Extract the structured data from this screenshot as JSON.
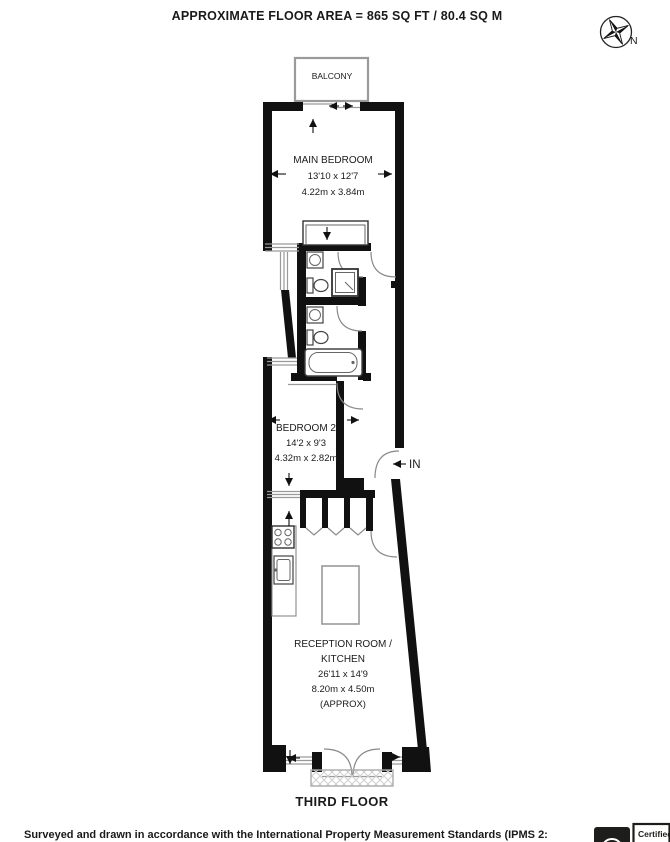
{
  "title": "APPROXIMATE FLOOR AREA = 865 SQ FT / 80.4 SQ M",
  "compass": {
    "north_label": "N"
  },
  "balcony_label": "BALCONY",
  "rooms": {
    "main_bedroom": {
      "name": "MAIN BEDROOM",
      "imperial": "13'10 x 12'7",
      "metric": "4.22m x 3.84m"
    },
    "bedroom2": {
      "name": "BEDROOM 2",
      "imperial": "14'2 x 9'3",
      "metric": "4.32m x 2.82m"
    },
    "reception": {
      "name_line1": "RECEPTION ROOM /",
      "name_line2": "KITCHEN",
      "imperial": "26'11 x 14'9",
      "metric": "8.20m x 4.50m",
      "approx": "(APPROX)"
    }
  },
  "entrance_label": "IN",
  "floor_label": "THIRD FLOOR",
  "footer": {
    "disclaimer": "Surveyed and drawn in accordance with the International Property Measurement Standards (IPMS 2:",
    "badge_label": "Certified"
  },
  "icons": {
    "compass": "compass-rose-icon",
    "certification": "certified-badge-icon"
  },
  "colors": {
    "wall": "#111111",
    "thin_line": "#9a9a9a",
    "text": "#1a1a1a",
    "badge_dark": "#1d1d1b"
  }
}
